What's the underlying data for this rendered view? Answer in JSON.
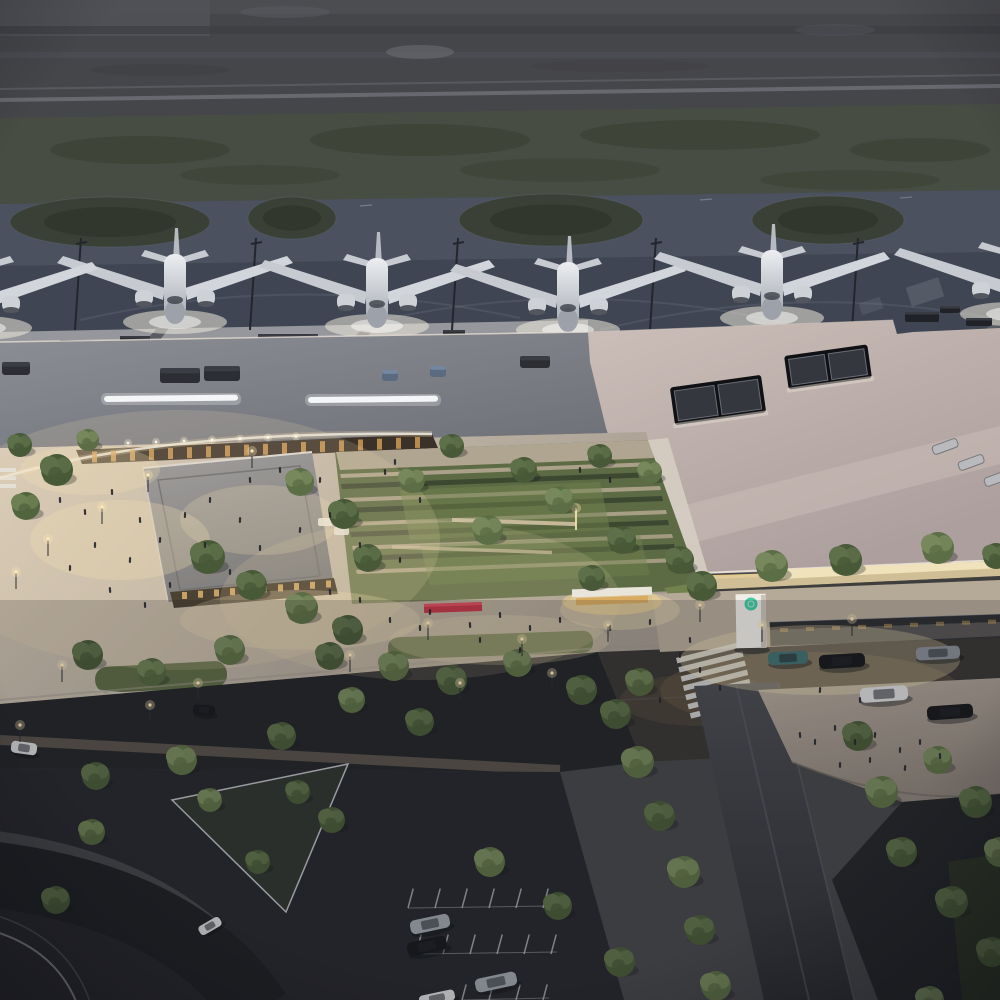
{
  "meta": {
    "description": "Aerial dusk architectural rendering of an airport terminal: four aircraft parked at gates on the apron, long terminal roofs, a landscaped courtyard with trees and lit plazas, curbside road with cars, covered pedestrian walkway and parking lots",
    "time_of_day": "dusk",
    "aircraft_count": 4
  },
  "palette": {
    "field": "#45464a",
    "green1": "#484d43",
    "green2": "#3d4237",
    "taxi": "#4b515f",
    "apron": "#3f4553",
    "island": "#3a4036",
    "islandDark": "#30352b",
    "runwayLine": "#83868e",
    "pier": "#96979d",
    "fascia": "#e6ddd3",
    "warmStrip": "#e5bc5e",
    "glowWarm": "#f6e3b4",
    "glowPlane": "#efe9da",
    "arcade": "#3a3128",
    "woodLight": "#cf9a55",
    "lawn": "#5c6b44",
    "lawnLit": "#71824e",
    "hedge": "#3d4831",
    "stone": "#b4a792",
    "road": "#383634",
    "roadDark": "#232529",
    "parking": "#26282c",
    "red": "#c23848",
    "tealLogo": "#2ec79b",
    "people": "#23232a",
    "wing": "#c7cad1",
    "cars": {
      "white": "#d6d8da",
      "dark": "#17191d",
      "silver": "#9ba1a8",
      "teal": "#417070",
      "gray": "#878d95"
    },
    "tree_tones": [
      [
        "#6d8054",
        "#52643e"
      ],
      [
        "#5d7049",
        "#475937"
      ],
      [
        "#77895c",
        "#5c6e45"
      ]
    ]
  },
  "scene": {
    "aircraft": [
      {
        "x": 175,
        "y": 230
      },
      {
        "x": 377,
        "y": 234
      },
      {
        "x": 568,
        "y": 238
      },
      {
        "x": 772,
        "y": 226
      },
      {
        "x": 1012,
        "y": 222
      },
      {
        "x": -20,
        "y": 236
      }
    ],
    "masts": [
      75,
      250,
      452,
      650,
      852
    ],
    "grass_islands": [
      {
        "cx": 110,
        "cy": 222,
        "rx": 100,
        "ry": 25
      },
      {
        "cx": 292,
        "cy": 218,
        "rx": 44,
        "ry": 21
      },
      {
        "cx": 551,
        "cy": 220,
        "rx": 92,
        "ry": 26
      },
      {
        "cx": 828,
        "cy": 220,
        "rx": 76,
        "ry": 24
      }
    ],
    "apron_vehicles": [
      {
        "x": 60,
        "y": 340,
        "w": 34,
        "h": 10
      },
      {
        "x": 120,
        "y": 336,
        "w": 30,
        "h": 9
      },
      {
        "x": 258,
        "y": 334,
        "w": 60,
        "h": 10
      },
      {
        "x": 348,
        "y": 338,
        "w": 16,
        "h": 7
      },
      {
        "x": 443,
        "y": 330,
        "w": 22,
        "h": 8
      },
      {
        "x": 905,
        "y": 312,
        "w": 34,
        "h": 10
      },
      {
        "x": 940,
        "y": 306,
        "w": 20,
        "h": 7
      },
      {
        "x": 966,
        "y": 318,
        "w": 26,
        "h": 8
      }
    ],
    "rooftop_units": [
      {
        "x": 160,
        "y": 368,
        "w": 40,
        "h": 15,
        "blue": 0
      },
      {
        "x": 204,
        "y": 366,
        "w": 36,
        "h": 15,
        "blue": 0
      },
      {
        "x": 2,
        "y": 362,
        "w": 28,
        "h": 13,
        "blue": 0
      },
      {
        "x": 382,
        "y": 370,
        "w": 16,
        "h": 11,
        "blue": 1
      },
      {
        "x": 430,
        "y": 366,
        "w": 16,
        "h": 11,
        "blue": 1
      },
      {
        "x": 520,
        "y": 356,
        "w": 30,
        "h": 12,
        "blue": 0
      }
    ],
    "strip_lights": [
      {
        "x": 104,
        "y": 396,
        "w": 134
      },
      {
        "x": 308,
        "y": 397,
        "w": 130
      }
    ],
    "skylights": [
      {
        "cx": 718,
        "cy": 400,
        "w": 92,
        "h": 38,
        "rot": -8
      },
      {
        "cx": 828,
        "cy": 367,
        "w": 84,
        "h": 34,
        "rot": -8
      }
    ],
    "roof_vents": [
      {
        "x": 932,
        "y": 442
      },
      {
        "x": 958,
        "y": 458
      },
      {
        "x": 984,
        "y": 474
      }
    ],
    "crosswalk": {
      "x": 676,
      "y": 658,
      "bars": 7,
      "angle": -14,
      "w": 66,
      "h": 5.5,
      "gap": 9.5
    },
    "stall_rows": [
      {
        "x": 408,
        "y": 908,
        "n": 6,
        "len": 20,
        "gap": 27
      },
      {
        "x": 416,
        "y": 954,
        "n": 6,
        "len": 20,
        "gap": 27
      },
      {
        "x": 462,
        "y": 1000,
        "n": 4,
        "len": 16,
        "gap": 27
      }
    ],
    "cars": [
      {
        "x": 788,
        "y": 658,
        "w": 40,
        "h": 13,
        "rot": -3,
        "color": "teal"
      },
      {
        "x": 842,
        "y": 661,
        "w": 46,
        "h": 14,
        "rot": -3,
        "color": "dark"
      },
      {
        "x": 938,
        "y": 653,
        "w": 44,
        "h": 13,
        "rot": -3,
        "color": "gray"
      },
      {
        "x": 884,
        "y": 694,
        "w": 48,
        "h": 15,
        "rot": -4,
        "color": "white"
      },
      {
        "x": 950,
        "y": 712,
        "w": 46,
        "h": 14,
        "rot": -4,
        "color": "dark"
      },
      {
        "x": 204,
        "y": 710,
        "w": 22,
        "h": 10,
        "rot": 4,
        "color": "dark"
      },
      {
        "x": 24,
        "y": 748,
        "w": 26,
        "h": 12,
        "rot": 8,
        "color": "white"
      },
      {
        "x": 430,
        "y": 924,
        "w": 40,
        "h": 14,
        "rot": -12,
        "color": "silver"
      },
      {
        "x": 427,
        "y": 946,
        "w": 40,
        "h": 14,
        "rot": -12,
        "color": "dark"
      },
      {
        "x": 496,
        "y": 982,
        "w": 42,
        "h": 14,
        "rot": -12,
        "color": "silver"
      },
      {
        "x": 437,
        "y": 998,
        "w": 36,
        "h": 11,
        "rot": -12,
        "color": "white"
      },
      {
        "x": 210,
        "y": 926,
        "w": 24,
        "h": 10,
        "rot": -30,
        "color": "white"
      }
    ],
    "trees": [
      [
        57,
        470,
        16,
        1
      ],
      [
        26,
        506,
        14,
        0
      ],
      [
        208,
        557,
        17,
        1
      ],
      [
        252,
        585,
        15,
        1
      ],
      [
        302,
        608,
        16,
        2
      ],
      [
        348,
        630,
        15,
        1
      ],
      [
        88,
        655,
        15,
        1
      ],
      [
        152,
        672,
        14,
        0
      ],
      [
        230,
        650,
        15,
        2
      ],
      [
        330,
        656,
        14,
        1
      ],
      [
        394,
        666,
        15,
        2
      ],
      [
        452,
        680,
        15,
        1
      ],
      [
        518,
        663,
        14,
        2
      ],
      [
        582,
        690,
        15,
        1
      ],
      [
        640,
        682,
        14,
        0
      ],
      [
        300,
        482,
        14,
        2
      ],
      [
        344,
        514,
        15,
        1
      ],
      [
        368,
        558,
        14,
        1
      ],
      [
        412,
        480,
        13,
        2
      ],
      [
        452,
        446,
        12,
        1
      ],
      [
        488,
        530,
        15,
        2
      ],
      [
        524,
        470,
        13,
        1
      ],
      [
        560,
        500,
        14,
        2
      ],
      [
        600,
        456,
        12,
        1
      ],
      [
        622,
        540,
        14,
        1
      ],
      [
        650,
        472,
        12,
        2
      ],
      [
        592,
        578,
        13,
        1
      ],
      [
        680,
        560,
        14,
        1
      ],
      [
        702,
        586,
        15,
        1
      ],
      [
        772,
        566,
        16,
        2
      ],
      [
        846,
        560,
        16,
        1
      ],
      [
        938,
        548,
        16,
        2
      ],
      [
        996,
        556,
        13,
        1
      ],
      [
        616,
        714,
        15,
        1
      ],
      [
        638,
        762,
        16,
        2
      ],
      [
        660,
        816,
        15,
        1
      ],
      [
        684,
        872,
        16,
        2
      ],
      [
        700,
        930,
        15,
        1
      ],
      [
        716,
        986,
        15,
        2
      ],
      [
        858,
        736,
        15,
        1
      ],
      [
        882,
        792,
        16,
        2
      ],
      [
        902,
        852,
        15,
        1
      ],
      [
        938,
        760,
        14,
        2
      ],
      [
        976,
        802,
        16,
        1
      ],
      [
        1000,
        852,
        15,
        2
      ],
      [
        952,
        902,
        16,
        1
      ],
      [
        992,
        952,
        15,
        1
      ],
      [
        930,
        1000,
        14,
        2
      ],
      [
        96,
        776,
        14,
        1
      ],
      [
        182,
        760,
        15,
        2
      ],
      [
        282,
        736,
        14,
        1
      ],
      [
        352,
        700,
        13,
        2
      ],
      [
        420,
        722,
        14,
        1
      ],
      [
        92,
        832,
        13,
        0
      ],
      [
        56,
        900,
        14,
        1
      ],
      [
        332,
        820,
        13,
        1
      ],
      [
        490,
        862,
        15,
        2
      ],
      [
        558,
        906,
        14,
        1
      ],
      [
        620,
        962,
        15,
        1
      ],
      [
        210,
        800,
        12,
        2
      ],
      [
        298,
        792,
        12,
        1
      ],
      [
        258,
        862,
        12,
        1
      ],
      [
        20,
        445,
        12,
        1
      ],
      [
        88,
        440,
        11,
        2
      ]
    ],
    "people": [
      [
        60,
        500
      ],
      [
        85,
        512
      ],
      [
        112,
        492
      ],
      [
        140,
        520
      ],
      [
        95,
        545
      ],
      [
        70,
        568
      ],
      [
        130,
        560
      ],
      [
        160,
        540
      ],
      [
        185,
        515
      ],
      [
        210,
        500
      ],
      [
        240,
        520
      ],
      [
        205,
        545
      ],
      [
        170,
        585
      ],
      [
        145,
        605
      ],
      [
        110,
        590
      ],
      [
        230,
        572
      ],
      [
        260,
        548
      ],
      [
        300,
        530
      ],
      [
        330,
        515
      ],
      [
        360,
        545
      ],
      [
        400,
        560
      ],
      [
        250,
        480
      ],
      [
        280,
        470
      ],
      [
        320,
        480
      ],
      [
        390,
        620
      ],
      [
        420,
        628
      ],
      [
        470,
        625
      ],
      [
        500,
        615
      ],
      [
        530,
        628
      ],
      [
        560,
        620
      ],
      [
        610,
        628
      ],
      [
        650,
        622
      ],
      [
        430,
        612
      ],
      [
        480,
        640
      ],
      [
        520,
        650
      ],
      [
        360,
        600
      ],
      [
        330,
        592
      ],
      [
        680,
        655
      ],
      [
        700,
        670
      ],
      [
        720,
        688
      ],
      [
        660,
        700
      ],
      [
        690,
        640
      ],
      [
        800,
        735
      ],
      [
        815,
        742
      ],
      [
        835,
        728
      ],
      [
        855,
        742
      ],
      [
        875,
        735
      ],
      [
        900,
        750
      ],
      [
        920,
        742
      ],
      [
        940,
        756
      ],
      [
        870,
        760
      ],
      [
        905,
        768
      ],
      [
        840,
        765
      ],
      [
        820,
        690
      ],
      [
        860,
        700
      ],
      [
        385,
        472
      ],
      [
        420,
        500
      ],
      [
        395,
        462
      ],
      [
        580,
        470
      ],
      [
        610,
        480
      ]
    ],
    "light_poles": [
      [
        48,
        556
      ],
      [
        102,
        524
      ],
      [
        16,
        589
      ],
      [
        148,
        492
      ],
      [
        252,
        468
      ],
      [
        62,
        682
      ],
      [
        198,
        700
      ],
      [
        428,
        640
      ],
      [
        522,
        656
      ],
      [
        608,
        642
      ],
      [
        700,
        622
      ],
      [
        762,
        642
      ],
      [
        852,
        636
      ],
      [
        552,
        690
      ],
      [
        150,
        722
      ],
      [
        20,
        742
      ],
      [
        350,
        672
      ],
      [
        460,
        700
      ]
    ],
    "glow_pools": [
      [
        120,
        540,
        90,
        40,
        0.28
      ],
      [
        260,
        520,
        80,
        35,
        0.22
      ],
      [
        300,
        620,
        120,
        30,
        0.25
      ],
      [
        500,
        640,
        110,
        25,
        0.22
      ],
      [
        620,
        610,
        60,
        20,
        0.3
      ],
      [
        820,
        660,
        140,
        35,
        0.3
      ],
      [
        90,
        470,
        70,
        25,
        0.25
      ],
      [
        180,
        540,
        260,
        130,
        0.16
      ],
      [
        420,
        600,
        200,
        80,
        0.14
      ]
    ]
  }
}
